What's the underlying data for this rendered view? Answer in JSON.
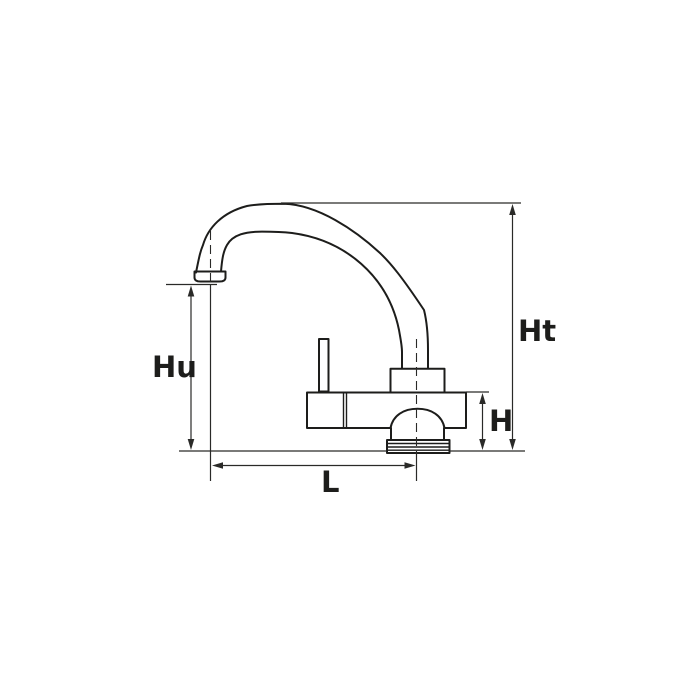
{
  "diagram": {
    "type": "technical-dimension-drawing",
    "subject": "faucet side view with dimension lines",
    "background_color": "#ffffff",
    "line_color": "#1d1d1b",
    "labels": {
      "hu": "Hu",
      "ht": "Ht",
      "h": "H",
      "l": "L"
    }
  }
}
